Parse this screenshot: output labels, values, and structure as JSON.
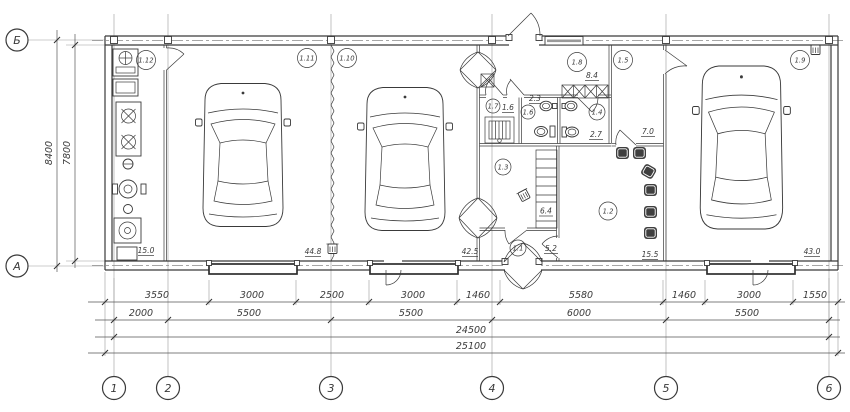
{
  "plan": {
    "left_axes": [
      {
        "label": "Б"
      },
      {
        "label": "А"
      }
    ],
    "bottom_axes": [
      {
        "label": "1"
      },
      {
        "label": "2"
      },
      {
        "label": "3"
      },
      {
        "label": "4"
      },
      {
        "label": "5"
      },
      {
        "label": "6"
      }
    ],
    "vertical_dims": [
      {
        "value": "8400"
      },
      {
        "value": "7800"
      }
    ],
    "dim_row_detail": [
      {
        "value": "3550"
      },
      {
        "value": "3000"
      },
      {
        "value": "2500"
      },
      {
        "value": "3000"
      },
      {
        "value": "1460"
      },
      {
        "value": "5580"
      },
      {
        "value": "1460"
      },
      {
        "value": "3000"
      },
      {
        "value": "1550"
      }
    ],
    "dim_row_axes": [
      {
        "value": "2000"
      },
      {
        "value": "5500"
      },
      {
        "value": "5500"
      },
      {
        "value": "6000"
      },
      {
        "value": "5500"
      }
    ],
    "dim_subtotal": "24500",
    "dim_total": "25100",
    "rooms": [
      {
        "number": "1.12",
        "area": "15.0"
      },
      {
        "number": "1.11",
        "area": "44.8"
      },
      {
        "number": "1.10",
        "area": "42.5"
      },
      {
        "number": "1.8",
        "area": "8.4"
      },
      {
        "number": "1.5",
        "area": "7.0"
      },
      {
        "number": "1.9",
        "area": "43.0"
      },
      {
        "number": "1.7",
        "area": "1.6"
      },
      {
        "number": "1.6",
        "area": "2.3"
      },
      {
        "number": "1.4",
        "area": "2.7"
      },
      {
        "number": "1.3",
        "area": "6.4"
      },
      {
        "number": "1.2",
        "area": "15.5"
      },
      {
        "number": "1.1",
        "area": "5.2"
      }
    ],
    "colors": {
      "line": "#3a3a3a",
      "grid": "#9a9a9a"
    }
  }
}
